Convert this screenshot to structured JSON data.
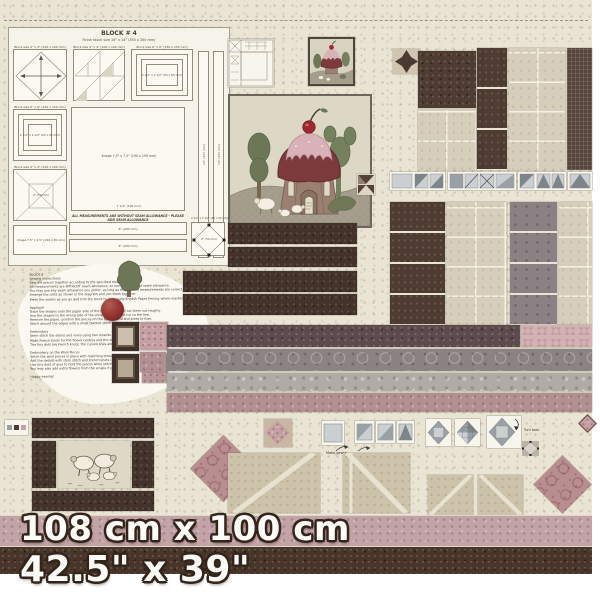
{
  "panel": {
    "header": {
      "title": "BLOCK # 4",
      "subtitle": "Finish block size 14\" x 14\"  (350 x 350 mm)"
    },
    "seam_note": "ALL MEASUREMENTS ARE WITHOUT SEAM ALLOWANCE - PLEASE ADD SEAM ALLOWANCE",
    "dimensions": {
      "metric": "108 cm x 100 cm",
      "imperial": "42.5\" x 39\""
    }
  },
  "labels": {
    "block_4x4": "Block size 4\" x 4\"  (100 x 100 mm)",
    "block_6x6": "Block size 6\" x 6\"  (150 x 150 mm)",
    "image_7575": "Image 7,5\" x 7,5\"  (190 x 190 mm)",
    "image_7525": "Image 7,5\" x 2,5\"  (190 x 65 mm)",
    "dim_2in": "2\"  (50 mm)",
    "dim_8in": "8\"  (200 mm)",
    "dim_14in": "14\"  (355 mm)",
    "dim_7half": "7 1/2\"  (190 mm)",
    "square_2half": "2 1/2\" x 2 1/2\"  (65 x 65 mm)"
  },
  "annotations": {
    "make_geese": "Make geese",
    "turn_back": "Turn back"
  },
  "instructions": {
    "text": "BLOCK 4\nSewing instructions\nSew the pieces together according to the specified measurements.\nAll measurements are WITHOUT seam allowance, so remember to add seam allowance.\nYou may use any seam allowance you prefer, as long as the finished measurements are correct.\nArrange the units as shown in the diagram and join them together.\nPress the seams as you go and trim the block to size, using English Paper Piecing where marked.\n\nAppliqué\nTrace the shapes onto the paper side of the fusible web and cut them out roughly.\nIron the shapes to the wrong side of the chosen fabrics and cut on the line.\nRemove the paper, position the pieces on the background and press to fuse.\nStitch around the edges with a small blanket stitch using matching thread.\n\nEmbroidery\nStem stitch the stems and vines using two strands of floss.\nMake French knots for the flower centres and the sheep eyes.\nThe tiny dots are French knots; the curved lines are stem stitch.\n\nEmbroidery on the Wool Pieces\nStitch the wool pieces in place with matching thread.\nAdd the details with stem stitch and French knots (2 strands).\nUse tiny dots of glue to hold the pieces while stitching if desired.\nYou may also add extra flowers from the scraps if you wish.\n\nHappy sewing!"
  },
  "colors": {
    "background_cream": "#e9e4d4",
    "dark_brown_fabric": "#4e3b31",
    "beige_tile_fabric": "#d6cebb",
    "pink_fabric": "#c6a1a3",
    "mauve_fabric": "#b19092",
    "grey_fabric": "#8b8284",
    "roof_maroon": "#7c3a3c",
    "frosting_pink": "#d8b2b8",
    "cherry_red": "#9e2931",
    "tree_green": "#6d7657",
    "bottom_pink_strip": "#c2a3a7",
    "bottom_brown_strip": "#49362b"
  }
}
